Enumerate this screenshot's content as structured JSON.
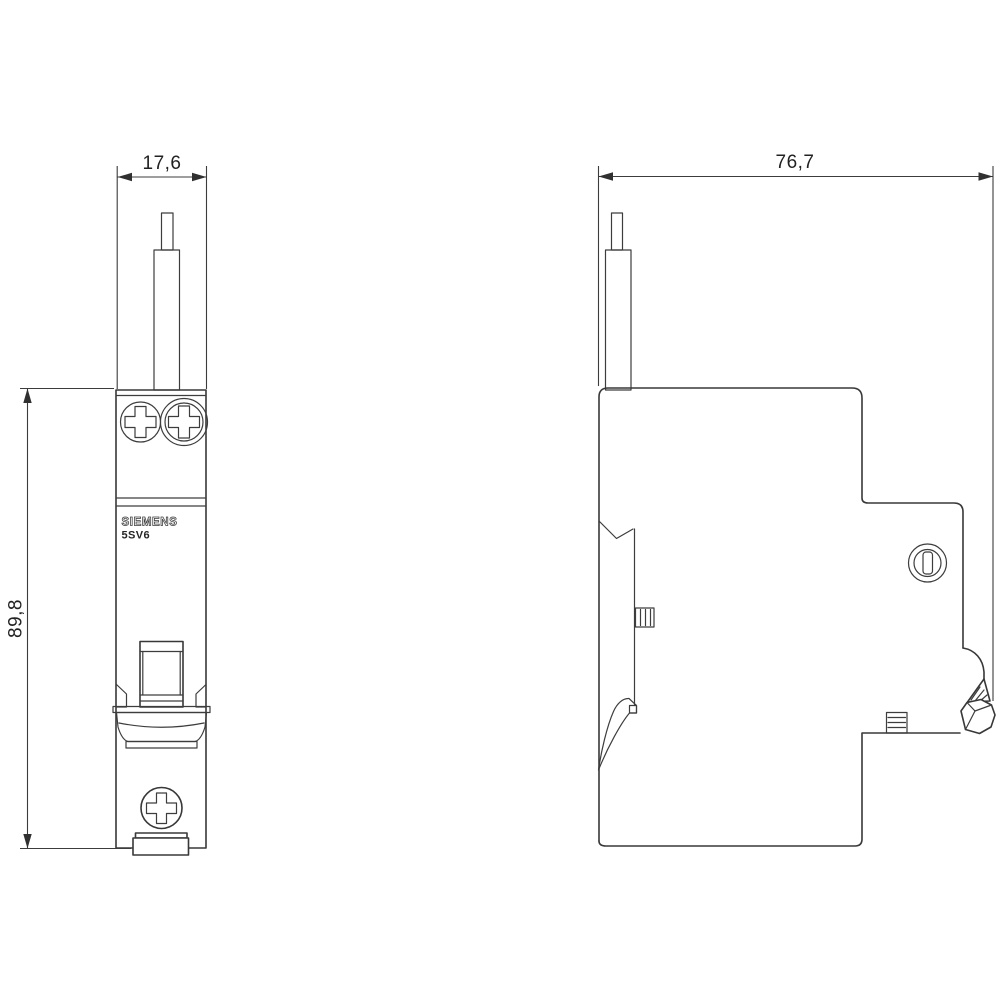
{
  "page": {
    "background_color": "#ffffff",
    "line_color": "#383838",
    "dimension_line_color": "#3c3c3c",
    "text_color": "#222222"
  },
  "drawing": {
    "brand_label": "SIEMENS",
    "model_label": "5SV6",
    "dimensions": {
      "front_width": "17,6",
      "front_height": "89,8",
      "side_depth": "76,7"
    }
  }
}
